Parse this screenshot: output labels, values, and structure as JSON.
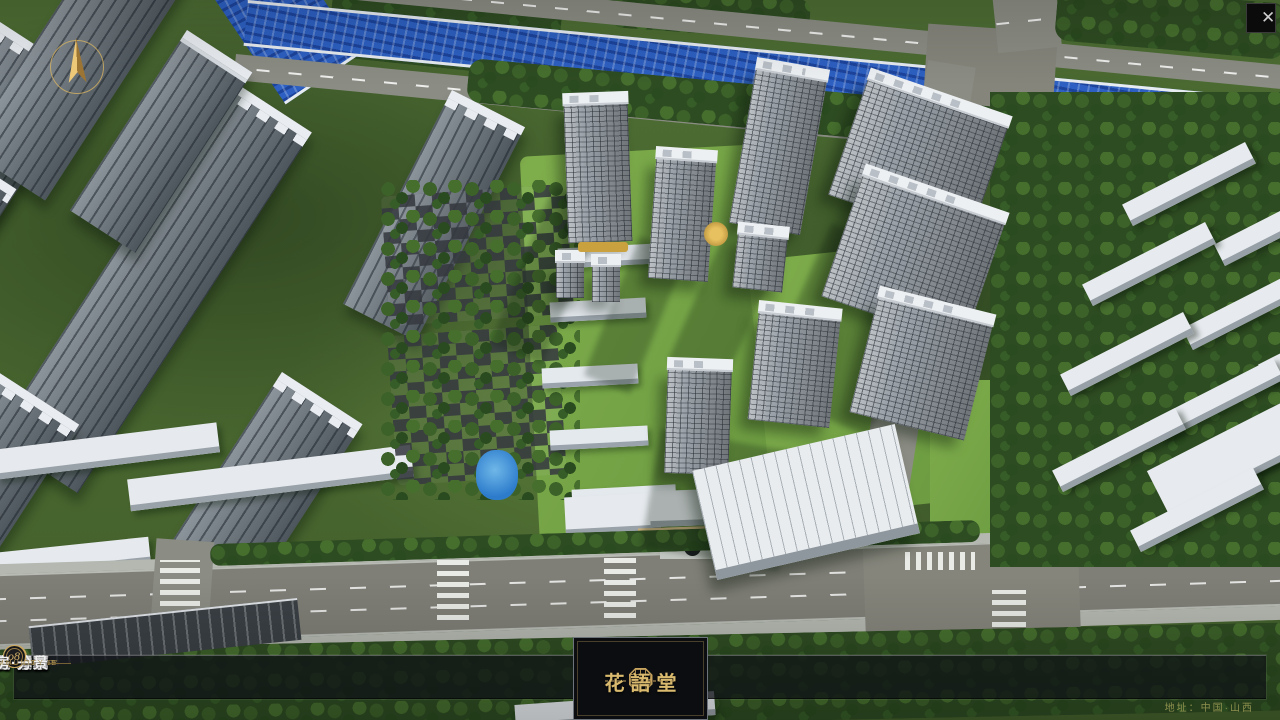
{
  "window": {
    "close_glyph": "✕"
  },
  "navbar": {
    "items": [
      {
        "num": "o1",
        "label": "品牌·介绍",
        "caption": "BRAND SUPPORT"
      },
      {
        "num": "o2",
        "label": "区位·价值",
        "caption": "LOCATION VALUE"
      },
      {
        "num": "o3",
        "label": "项目·概况",
        "caption": "PROJECT SURVEY"
      },
      {
        "num": "o4",
        "label": "建筑·鉴赏",
        "caption": "APPRECIATION"
      },
      {
        "num": "o5",
        "label": "园林·景观",
        "caption": "GARDEN STREET"
      },
      {
        "num": "o6",
        "label": "精装·体验",
        "caption": "EXPERIENCE"
      },
      {
        "num": "o7",
        "label": "户型·分布",
        "caption": "SHOW ROOM"
      },
      {
        "num": "o8",
        "label": "一房·一景",
        "caption": "COMMUNITY"
      }
    ]
  },
  "logo": {
    "title": "花語堂"
  },
  "footer": {
    "address": "地址：中国·山西"
  },
  "colors": {
    "gold": "#c9a85f",
    "river_blue": "#2d60c2",
    "navbar_bg": "rgba(15,17,21,0.74)"
  }
}
